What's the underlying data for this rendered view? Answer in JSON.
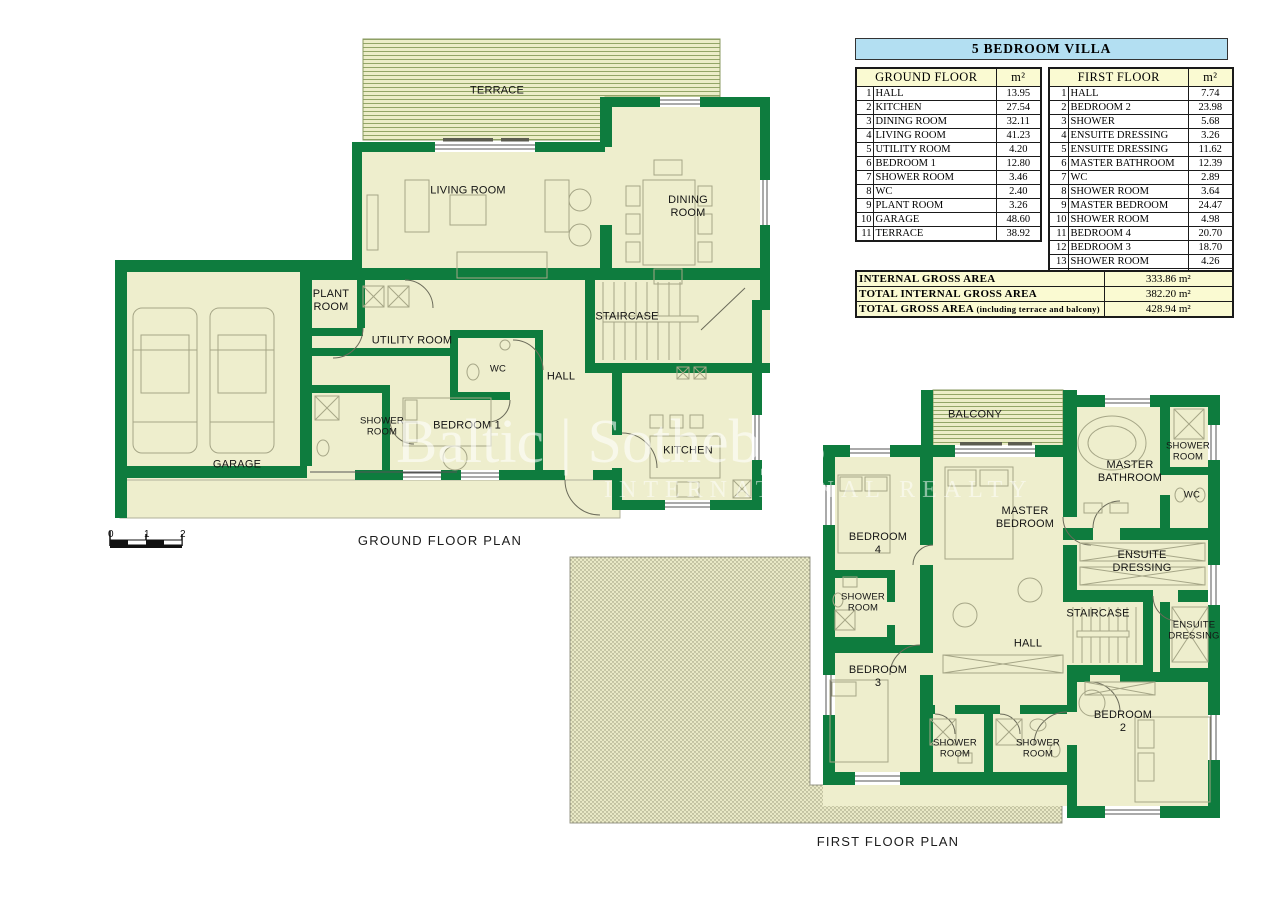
{
  "tables": {
    "title": "5 BEDROOM VILLA",
    "unit": "m²",
    "ground": {
      "header": "GROUND FLOOR",
      "rows": [
        {
          "num": "1",
          "name": "HALL",
          "area": "13.95"
        },
        {
          "num": "2",
          "name": "KITCHEN",
          "area": "27.54"
        },
        {
          "num": "3",
          "name": "DINING ROOM",
          "area": "32.11"
        },
        {
          "num": "4",
          "name": "LIVING ROOM",
          "area": "41.23"
        },
        {
          "num": "5",
          "name": "UTILITY ROOM",
          "area": "4.20"
        },
        {
          "num": "6",
          "name": "BEDROOM 1",
          "area": "12.80"
        },
        {
          "num": "7",
          "name": "SHOWER ROOM",
          "area": "3.46"
        },
        {
          "num": "8",
          "name": "WC",
          "area": "2.40"
        },
        {
          "num": "9",
          "name": "PLANT ROOM",
          "area": "3.26"
        },
        {
          "num": "10",
          "name": "GARAGE",
          "area": "48.60"
        },
        {
          "num": "11",
          "name": "TERRACE",
          "area": "38.92"
        }
      ]
    },
    "first": {
      "header": "FIRST FLOOR",
      "rows": [
        {
          "num": "1",
          "name": "HALL",
          "area": "7.74"
        },
        {
          "num": "2",
          "name": "BEDROOM 2",
          "area": "23.98"
        },
        {
          "num": "3",
          "name": "SHOWER",
          "area": "5.68"
        },
        {
          "num": "4",
          "name": "ENSUITE DRESSING",
          "area": "3.26"
        },
        {
          "num": "5",
          "name": "ENSUITE DRESSING",
          "area": "11.62"
        },
        {
          "num": "6",
          "name": "MASTER BATHROOM",
          "area": "12.39"
        },
        {
          "num": "7",
          "name": "WC",
          "area": "2.89"
        },
        {
          "num": "8",
          "name": "SHOWER ROOM",
          "area": "3.64"
        },
        {
          "num": "9",
          "name": "MASTER BEDROOM",
          "area": "24.47"
        },
        {
          "num": "10",
          "name": "SHOWER ROOM",
          "area": "4.98"
        },
        {
          "num": "11",
          "name": "BEDROOM 4",
          "area": "20.70"
        },
        {
          "num": "12",
          "name": "BEDROOM 3",
          "area": "18.70"
        },
        {
          "num": "13",
          "name": "SHOWER ROOM",
          "area": "4.26"
        },
        {
          "num": "14",
          "name": "BALCONY",
          "area": "7.84"
        }
      ]
    },
    "totals": [
      {
        "label": "INTERNAL GROSS AREA",
        "note": "",
        "value": "333.86 m²"
      },
      {
        "label": "TOTAL INTERNAL GROSS AREA",
        "note": "",
        "value": "382.20 m²"
      },
      {
        "label": "TOTAL GROSS AREA",
        "note": "(including terrace and balcony)",
        "value": "428.94 m²"
      }
    ]
  },
  "plans": {
    "ground": {
      "caption": "GROUND FLOOR PLAN",
      "labels": {
        "terrace": "TERRACE",
        "living": "LIVING ROOM",
        "dining": "DINING\nROOM",
        "plant": "PLANT\nROOM",
        "utility": "UTILITY ROOM",
        "wc": "WC",
        "staircase": "STAIRCASE",
        "hall": "HALL",
        "shower": "SHOWER\nROOM",
        "bedroom1": "BEDROOM 1",
        "kitchen": "KITCHEN",
        "garage": "GARAGE"
      }
    },
    "first": {
      "caption": "FIRST FLOOR PLAN",
      "labels": {
        "balcony": "BALCONY",
        "master_bathroom": "MASTER\nBATHROOM",
        "shower_top": "SHOWER\nROOM",
        "wc": "WC",
        "master_bedroom": "MASTER\nBEDROOM",
        "bedroom4": "BEDROOM\n4",
        "ensuite_upper": "ENSUITE\nDRESSING",
        "shower_left": "SHOWER\nROOM",
        "staircase": "STAIRCASE",
        "ensuite_lower": "ENSUITE\nDRESSING",
        "hall": "HALL",
        "bedroom3": "BEDROOM\n3",
        "shower_b1": "SHOWER\nROOM",
        "shower_b2": "SHOWER\nROOM",
        "bedroom2": "BEDROOM\n2"
      }
    }
  },
  "scale_bar": {
    "t0": "0",
    "t1": "1",
    "t2": "2"
  },
  "watermark": {
    "line1": "Baltic | Sotheby's",
    "line2": "INTERNATIONAL REALTY"
  },
  "colors": {
    "wall_green": "#0e7c3e",
    "room_fill": "#eeeecd",
    "title_blue": "#b3dff2",
    "header_yellow": "#fafad2"
  }
}
